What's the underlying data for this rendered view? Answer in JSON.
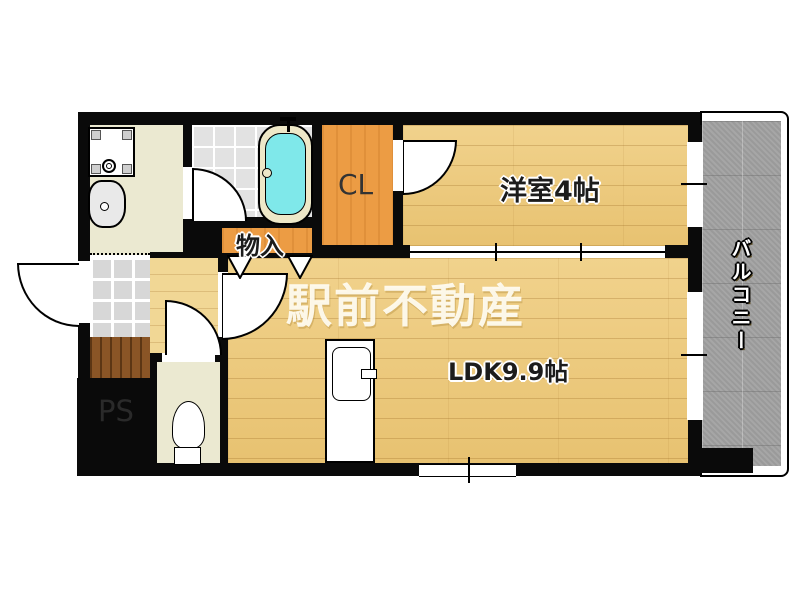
{
  "plan": {
    "type": "apartment-floor-plan",
    "watermark": {
      "text": "駅前不動産"
    },
    "rooms": {
      "yoshitsu": {
        "label": "洋室4帖"
      },
      "ldk": {
        "label": "LDK9.9帖"
      },
      "closet": {
        "label": "CL"
      },
      "monoire": {
        "label": "物入"
      },
      "ps": {
        "label": "PS"
      },
      "balcony": {
        "label": "バルコニー"
      }
    },
    "fixtures": [
      "bathtub",
      "washbasin",
      "washing-machine-pan",
      "toilet",
      "kitchen-counter",
      "entrance-tiles",
      "entrance-step",
      "sliding-door",
      "folding-doors"
    ],
    "colors": {
      "wall": "#0a0a0a",
      "wood_floor": "#ecc878",
      "hall_floor": "#f1d795",
      "closet_orange": "#ec9c44",
      "bathtub_cyan": "#7fe8ea",
      "balcony_gray": "#a2a2a2",
      "utility_cream": "#ebe9d1",
      "step_brown": "#8a5526"
    }
  }
}
